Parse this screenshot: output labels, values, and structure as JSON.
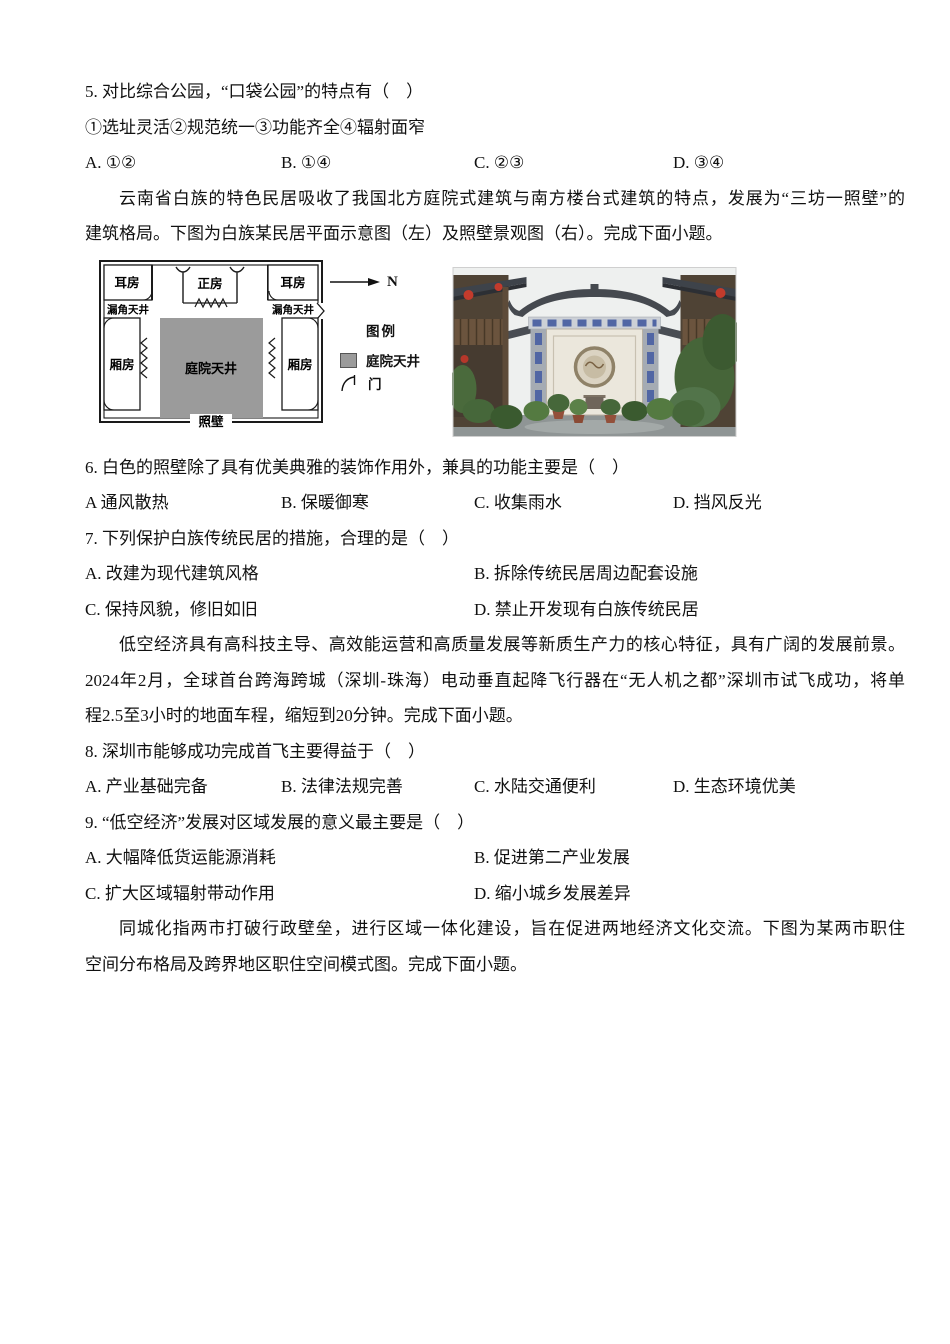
{
  "q5": {
    "stem": "5. 对比综合公园，“口袋公园”的特点有（　）",
    "statements": "①选址灵活②规范统一③功能齐全④辐射面窄",
    "options": [
      "A. ①②",
      "B. ①④",
      "C. ②③",
      "D. ③④"
    ]
  },
  "passage1": {
    "lines": [
      "云南省白族的特色民居吸收了我国北方庭院式建筑与南方楼台式建筑的特点，发展为“三坊一照壁”的",
      "建筑格局。下图为白族某民居平面示意图（左）及照壁景观图（右）。完成下面小题。"
    ]
  },
  "figure": {
    "plan": {
      "ear_room_left": "耳房",
      "main_room": "正房",
      "ear_room_right": "耳房",
      "corner_courtyard_left": "漏角天井",
      "corner_courtyard_right": "漏角天井",
      "wing_room_left": "厢房",
      "courtyard": "庭院天井",
      "wing_room_right": "厢房",
      "screen_wall": "照壁",
      "north_label": "N",
      "legend_title": "图例",
      "legend_courtyard": "庭院天井",
      "legend_door": "门",
      "courtyard_color": "#9b9b9b"
    }
  },
  "q6": {
    "stem": "6. 白色的照壁除了具有优美典雅的装饰作用外，兼具的功能主要是（　）",
    "options": [
      "A 通风散热",
      "B. 保暖御寒",
      "C. 收集雨水",
      "D. 挡风反光"
    ]
  },
  "q7": {
    "stem": "7. 下列保护白族传统民居的措施，合理的是（　）",
    "options": [
      "A. 改建为现代建筑风格",
      "B. 拆除传统民居周边配套设施",
      "C. 保持风貌，修旧如旧",
      "D. 禁止开发现有白族传统民居"
    ]
  },
  "passage2": {
    "lines": [
      "低空经济具有高科技主导、高效能运营和高质量发展等新质生产力的核心特征，具有广阔的发展前景。",
      "2024年2月，全球首台跨海跨城（深圳-珠海）电动垂直起降飞行器在“无人机之都”深圳市试飞成功，将单",
      "程2.5至3小时的地面车程，缩短到20分钟。完成下面小题。"
    ]
  },
  "q8": {
    "stem": "8. 深圳市能够成功完成首飞主要得益于（　）",
    "options": [
      "A. 产业基础完备",
      "B. 法律法规完善",
      "C. 水陆交通便利",
      "D. 生态环境优美"
    ]
  },
  "q9": {
    "stem": "9. “低空经济”发展对区域发展的意义最主要是（　）",
    "options": [
      "A. 大幅降低货运能源消耗",
      "B. 促进第二产业发展",
      "C. 扩大区域辐射带动作用",
      "D. 缩小城乡发展差异"
    ]
  },
  "passage3": {
    "lines": [
      "同城化指两市打破行政壁垒，进行区域一体化建设，旨在促进两地经济文化交流。下图为某两市职住",
      "空间分布格局及跨界地区职住空间模式图。完成下面小题。"
    ]
  }
}
